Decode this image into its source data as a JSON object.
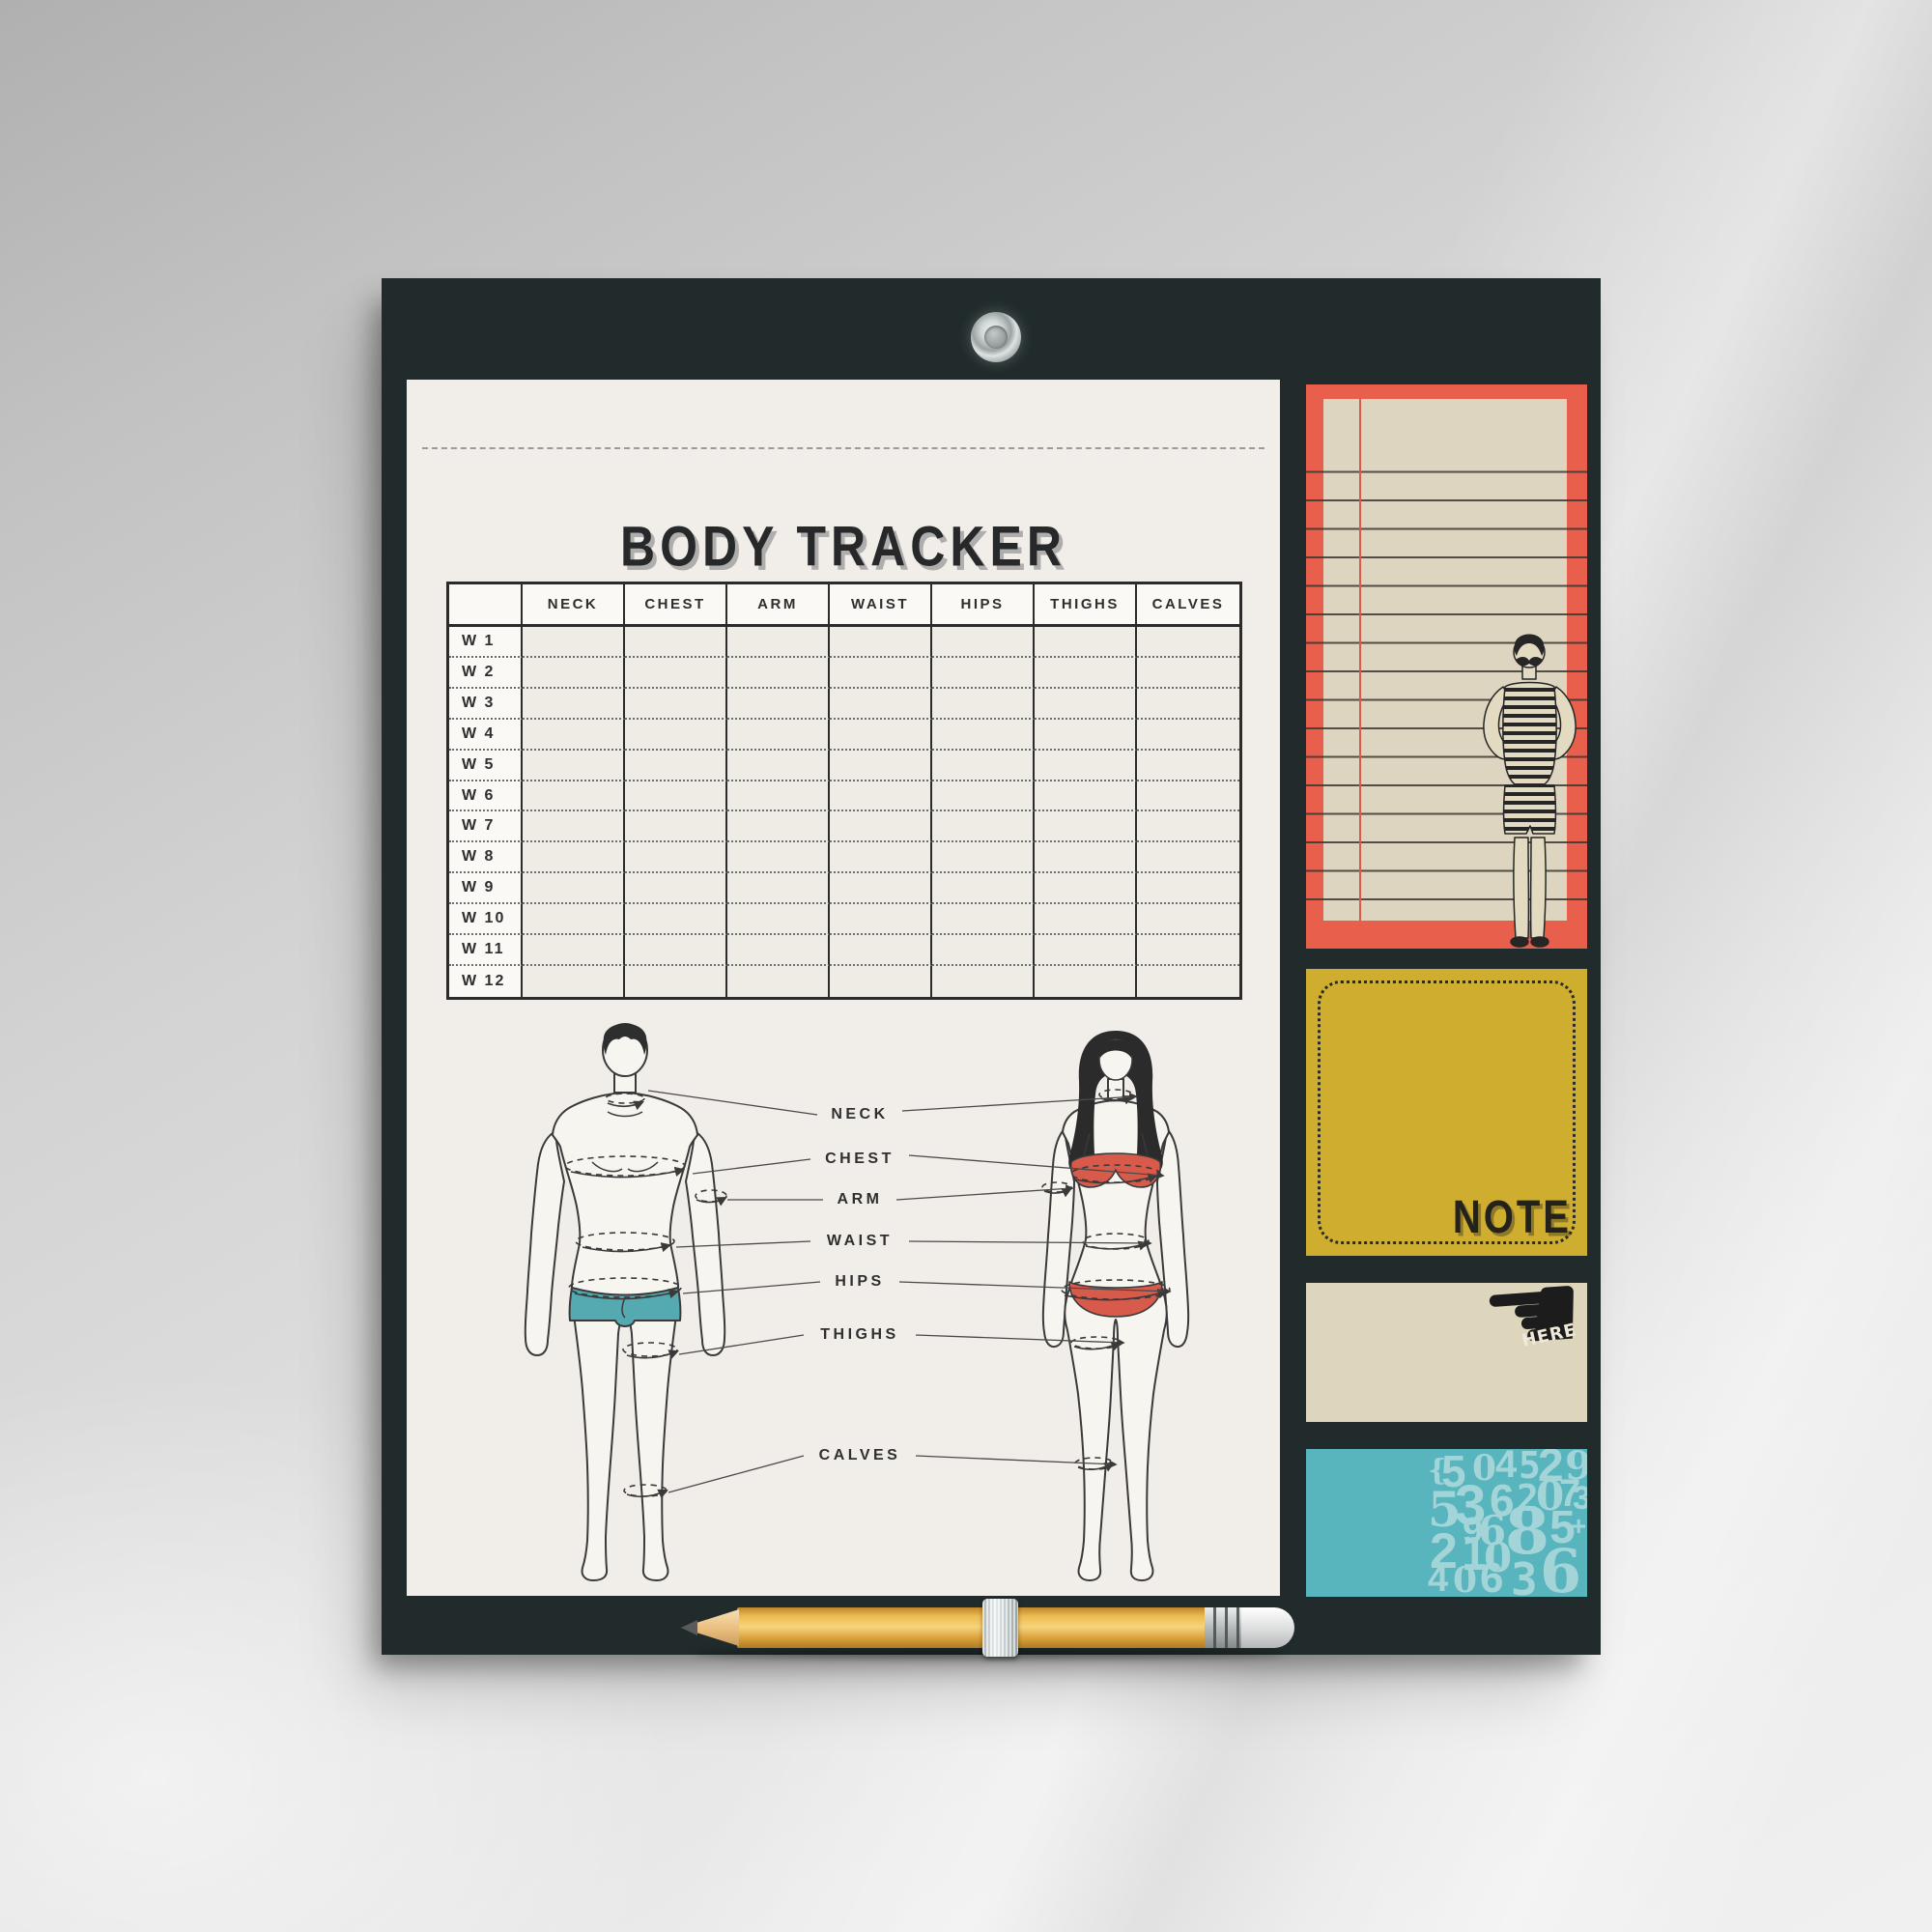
{
  "sheet": {
    "title": "BODY TRACKER",
    "table": {
      "columns": [
        "NECK",
        "CHEST",
        "ARM",
        "WAIST",
        "HIPS",
        "THIGHS",
        "CALVES"
      ],
      "weeks": [
        "W 1",
        "W 2",
        "W 3",
        "W 4",
        "W 5",
        "W 6",
        "W 7",
        "W 8",
        "W 9",
        "W 10",
        "W 11",
        "W 12"
      ]
    },
    "diagram_labels": [
      "NECK",
      "CHEST",
      "ARM",
      "WAIST",
      "HIPS",
      "THIGHS",
      "CALVES"
    ]
  },
  "notes": {
    "note_label": "NOTE",
    "here_label": "HERE",
    "numbers": [
      "{",
      "5",
      "0",
      "4",
      "5",
      "2",
      "9",
      "3",
      "5",
      "3",
      "6",
      "2",
      "0",
      "7",
      "6",
      "9",
      "8",
      "5",
      "2",
      "1",
      "0",
      "4",
      "0",
      "6",
      "3",
      "6",
      "+"
    ]
  },
  "icons": {
    "pointing_hand_icon": "☚"
  },
  "colors": {
    "board": "#212b2c",
    "sheet": "#f1eeea",
    "note_red": "#e8604c",
    "note_paper": "#ddd5c0",
    "note_mustard": "#cfae2f",
    "note_beige": "#ded5bd",
    "note_teal": "#58b4bd",
    "digits": "#a3d4d8",
    "pencil_yellow": "#ecb54d",
    "shorts_teal": "#55aab2",
    "bikini_red": "#d85a4a",
    "line_dark": "#3a3a3a"
  }
}
